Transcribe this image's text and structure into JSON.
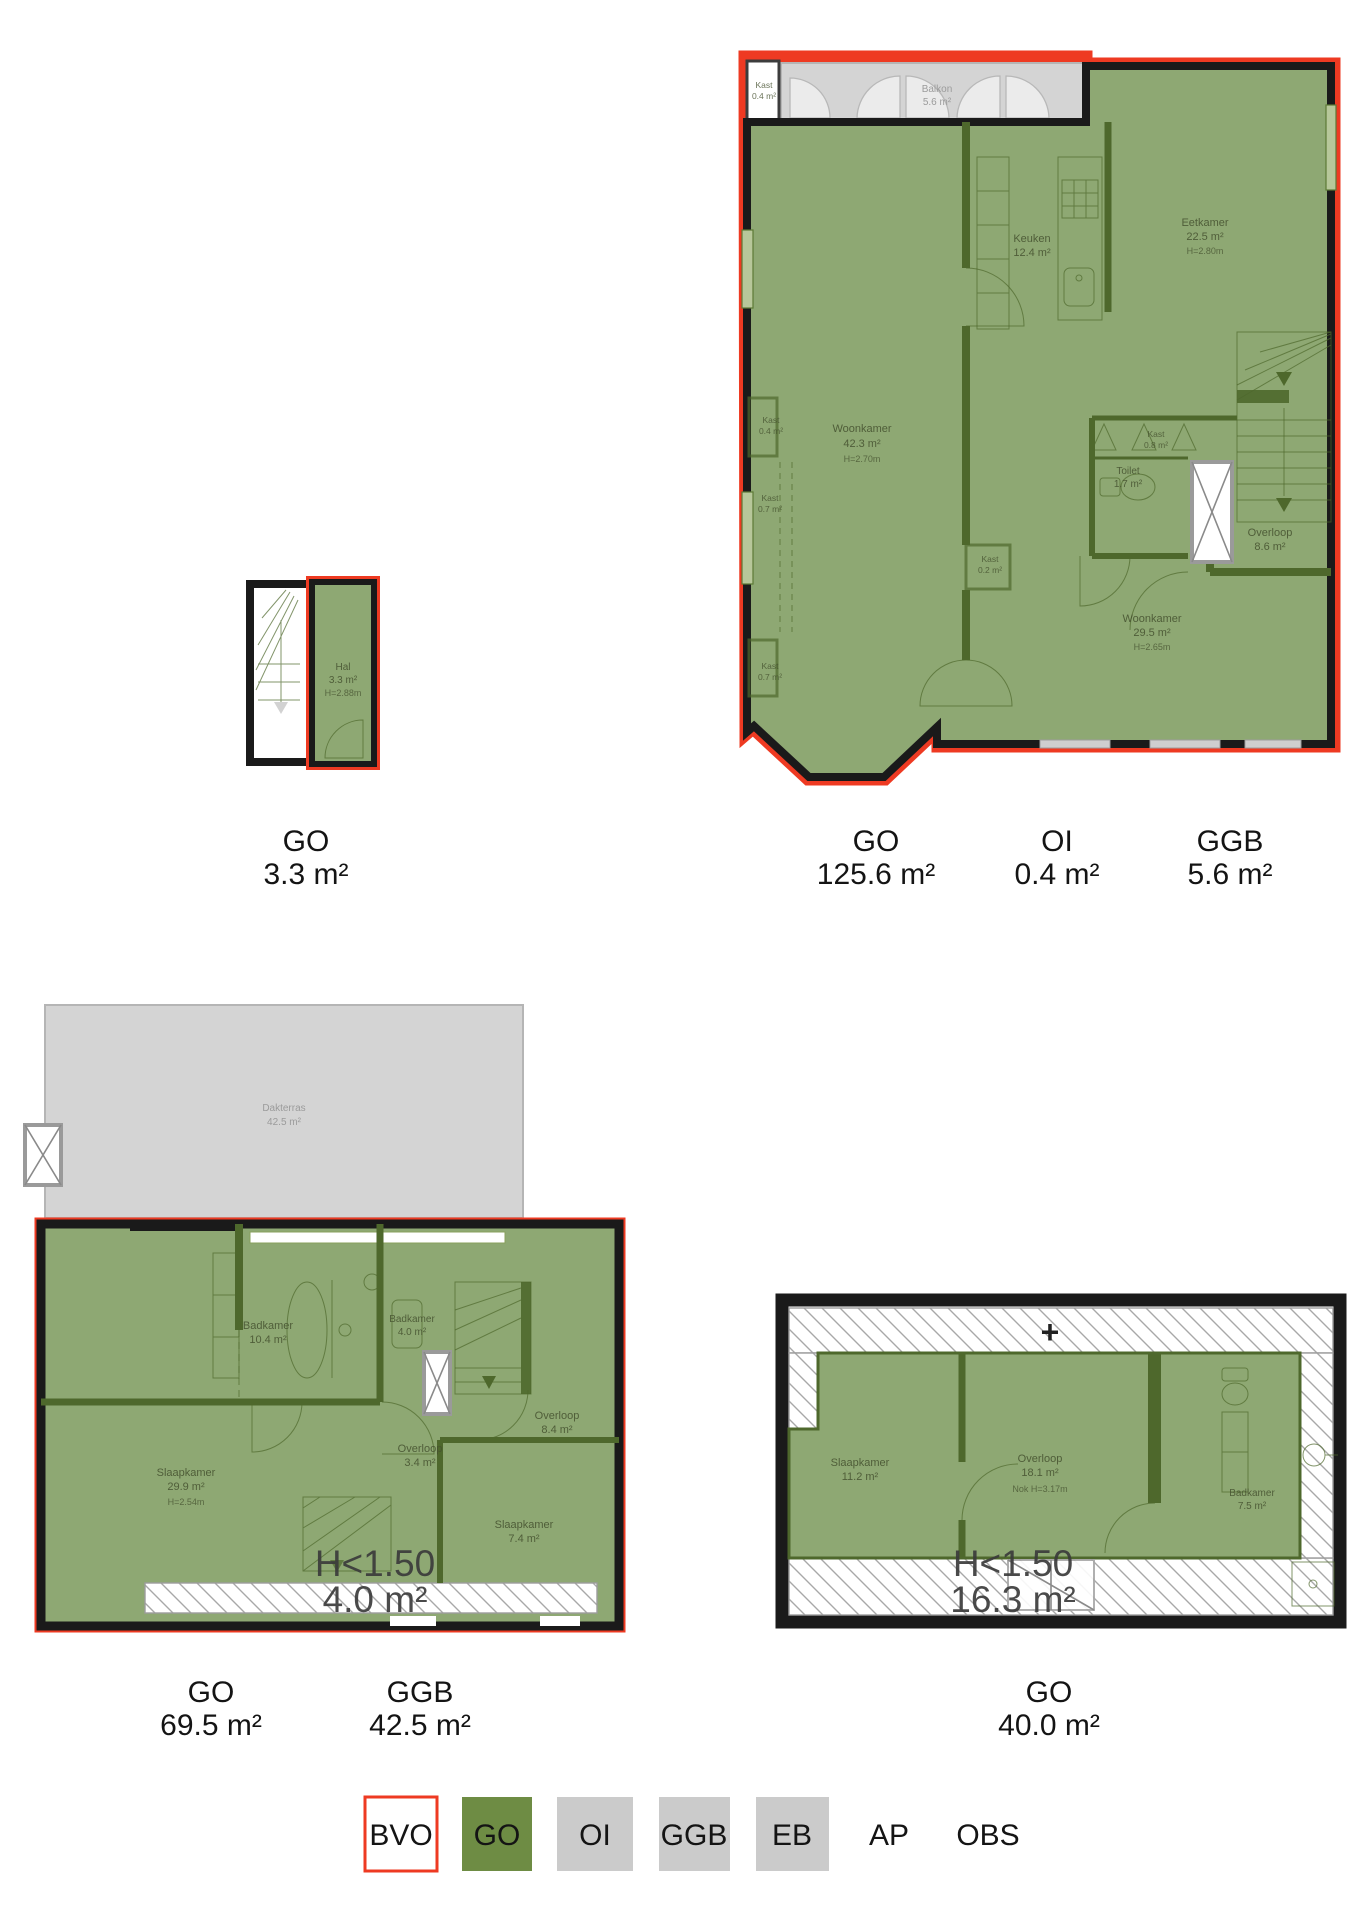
{
  "colors": {
    "outline_red": "#ee3a22",
    "wall_black": "#1a1a1a",
    "go_green_fill": "#8ea873",
    "go_green_dark": "#4e682c",
    "go_green_legend": "#6e8c44",
    "ggb_gray": "#d4d4d4",
    "legend_gray": "#cbcbcb",
    "gray_text": "#9b9b9b",
    "room_text": "#45512f"
  },
  "plans": [
    {
      "title": "ground-floor-entrance",
      "rooms": [
        {
          "name": "Hal",
          "area": "3.3 m²",
          "height": "H=2.88m"
        }
      ],
      "totals": [
        {
          "code": "GO",
          "value": "3.3 m²"
        }
      ]
    },
    {
      "title": "first-floor",
      "rooms": [
        {
          "name": "Balkon",
          "area": "5.6 m²"
        },
        {
          "name": "Kast",
          "area": "0.4 m²"
        },
        {
          "name": "Keuken",
          "area": "12.4 m²"
        },
        {
          "name": "Eetkamer",
          "area": "22.5 m²",
          "height": "H=2.80m"
        },
        {
          "name": "Woonkamer",
          "area": "42.3 m²",
          "height": "H=2.70m"
        },
        {
          "name": "Kast",
          "area": "0.4 m²"
        },
        {
          "name": "Kast",
          "area": "0.7 m²"
        },
        {
          "name": "Kast",
          "area": "0.7 m²"
        },
        {
          "name": "Kast",
          "area": "0.2 m²"
        },
        {
          "name": "Kast",
          "area": "0.8 m²"
        },
        {
          "name": "Toilet",
          "area": "1.7 m²"
        },
        {
          "name": "Overloop",
          "area": "8.6 m²"
        },
        {
          "name": "Woonkamer",
          "area": "29.5 m²",
          "height": "H=2.65m"
        }
      ],
      "totals": [
        {
          "code": "GO",
          "value": "125.6 m²"
        },
        {
          "code": "OI",
          "value": "0.4 m²"
        },
        {
          "code": "GGB",
          "value": "5.6 m²"
        }
      ]
    },
    {
      "title": "second-floor",
      "rooms": [
        {
          "name": "Dakterras",
          "area": "42.5 m²"
        },
        {
          "name": "Badkamer",
          "area": "10.4 m²"
        },
        {
          "name": "Badkamer",
          "area": "4.0 m²"
        },
        {
          "name": "Overloop",
          "area": "8.4 m²"
        },
        {
          "name": "Overloop",
          "area": "3.4 m²"
        },
        {
          "name": "Slaapkamer",
          "area": "29.9 m²",
          "height": "H=2.54m"
        },
        {
          "name": "Slaapkamer",
          "area": "7.4 m²"
        }
      ],
      "low_height": {
        "label": "H<1.50",
        "area": "4.0 m²"
      },
      "totals": [
        {
          "code": "GO",
          "value": "69.5 m²"
        },
        {
          "code": "GGB",
          "value": "42.5 m²"
        }
      ]
    },
    {
      "title": "third-floor",
      "rooms": [
        {
          "name": "Slaapkamer",
          "area": "11.2 m²"
        },
        {
          "name": "Overloop",
          "area": "18.1 m²",
          "height": "Nok H=3.17m"
        },
        {
          "name": "Badkamer",
          "area": "7.5 m²"
        }
      ],
      "low_height": {
        "label": "H<1.50",
        "area": "16.3 m²"
      },
      "roof_marker": "+",
      "totals": [
        {
          "code": "GO",
          "value": "40.0 m²"
        }
      ]
    }
  ],
  "legend": {
    "items": [
      {
        "code": "BVO",
        "swatch": "bvo"
      },
      {
        "code": "GO",
        "swatch": "green"
      },
      {
        "code": "OI",
        "swatch": "gray"
      },
      {
        "code": "GGB",
        "swatch": "gray"
      },
      {
        "code": "EB",
        "swatch": "gray"
      },
      {
        "code": "AP",
        "swatch": "none"
      },
      {
        "code": "OBS",
        "swatch": "none"
      }
    ]
  }
}
